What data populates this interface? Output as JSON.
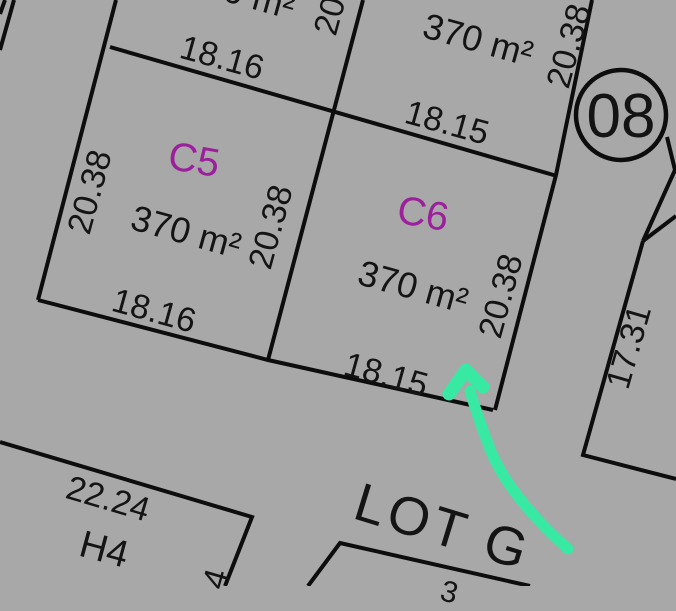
{
  "map": {
    "type": "cadastral-plat-map",
    "colors": {
      "background": "#a8a8a8",
      "line": "#0d0d0d",
      "text": "#141414",
      "lot_label": "#9c1f9c",
      "arrow": "#38e9a4"
    },
    "block_circle": {
      "number": "08"
    },
    "lots": [
      {
        "id": "C5",
        "area": "370 m²",
        "width": "18.16",
        "depth": "20.38"
      },
      {
        "id": "C6",
        "area": "370 m²",
        "width": "18.15",
        "depth": "20.38"
      },
      {
        "id": "H4",
        "frontage": "22.24"
      }
    ],
    "road_label": "LOT G",
    "labels": [
      {
        "name": "dim-c5-top",
        "text": "18.16",
        "x": 222,
        "y": 58,
        "rot": 15.5,
        "size": 34
      },
      {
        "name": "dim-c6-top",
        "text": "18.15",
        "x": 447,
        "y": 123,
        "rot": 15.5,
        "size": 34
      },
      {
        "name": "area-top-right-lot",
        "text": "370 m²",
        "x": 478,
        "y": 40,
        "rot": 15.5,
        "size": 36
      },
      {
        "name": "area-top-left-lot-clipped",
        "text": "370 m²",
        "x": 240,
        "y": -7,
        "rot": 15.5,
        "size": 36
      },
      {
        "name": "lot-label-c5",
        "text": "C5",
        "x": 194,
        "y": 160,
        "rot": 10,
        "size": 40,
        "color": "lot_label"
      },
      {
        "name": "lot-label-c6",
        "text": "C6",
        "x": 423,
        "y": 214,
        "rot": 10,
        "size": 40,
        "color": "lot_label"
      },
      {
        "name": "area-c5",
        "text": "370 m²",
        "x": 186,
        "y": 232,
        "rot": 15.5,
        "size": 36
      },
      {
        "name": "area-c6",
        "text": "370 m²",
        "x": 413,
        "y": 287,
        "rot": 15.5,
        "size": 36
      },
      {
        "name": "dim-c5-bottom",
        "text": "18.16",
        "x": 154,
        "y": 311,
        "rot": 15.5,
        "size": 34
      },
      {
        "name": "dim-c6-bottom",
        "text": "18.15",
        "x": 386,
        "y": 375,
        "rot": 15.5,
        "size": 34
      },
      {
        "name": "dim-c5-left",
        "text": "20.38",
        "x": 90,
        "y": 192,
        "rot": -74.5,
        "size": 34
      },
      {
        "name": "dim-c5-c6-divider",
        "text": "20.38",
        "x": 271,
        "y": 227,
        "rot": -74.5,
        "size": 34
      },
      {
        "name": "dim-c6-right",
        "text": "20.38",
        "x": 501,
        "y": 296,
        "rot": -74.5,
        "size": 34
      },
      {
        "name": "dim-top-right-lot",
        "text": "20.38",
        "x": 569,
        "y": 46,
        "rot": -74.5,
        "size": 34
      },
      {
        "name": "dim-divider-top-clipped",
        "text": "20",
        "x": 330,
        "y": 16,
        "rot": -74.5,
        "size": 34
      },
      {
        "name": "dim-right-lot",
        "text": "17.31",
        "x": 629,
        "y": 347,
        "rot": -74,
        "size": 34
      },
      {
        "name": "block-number",
        "text": "08",
        "x": 621,
        "y": 117,
        "rot": 0,
        "size": 62
      },
      {
        "name": "dim-h4-top",
        "text": "22.24",
        "x": 108,
        "y": 499,
        "rot": 16.5,
        "size": 34
      },
      {
        "name": "lot-label-h4",
        "text": "H4",
        "x": 104,
        "y": 550,
        "rot": 15,
        "size": 38
      },
      {
        "name": "road-label-lot-g",
        "text": "LOT G",
        "x": 443,
        "y": 527,
        "rot": 17,
        "size": 54,
        "ls": 4
      },
      {
        "name": "dim-h4-right-clipped",
        "text": "4",
        "x": 216,
        "y": 579,
        "rot": -74,
        "size": 34
      },
      {
        "name": "dim-bottom-lot-clipped",
        "text": "3",
        "x": 449,
        "y": 593,
        "rot": 15,
        "size": 30
      }
    ],
    "annotation": {
      "arrow": "hand-drawn green arrow pointing at lot C6 bottom-right corner"
    }
  }
}
